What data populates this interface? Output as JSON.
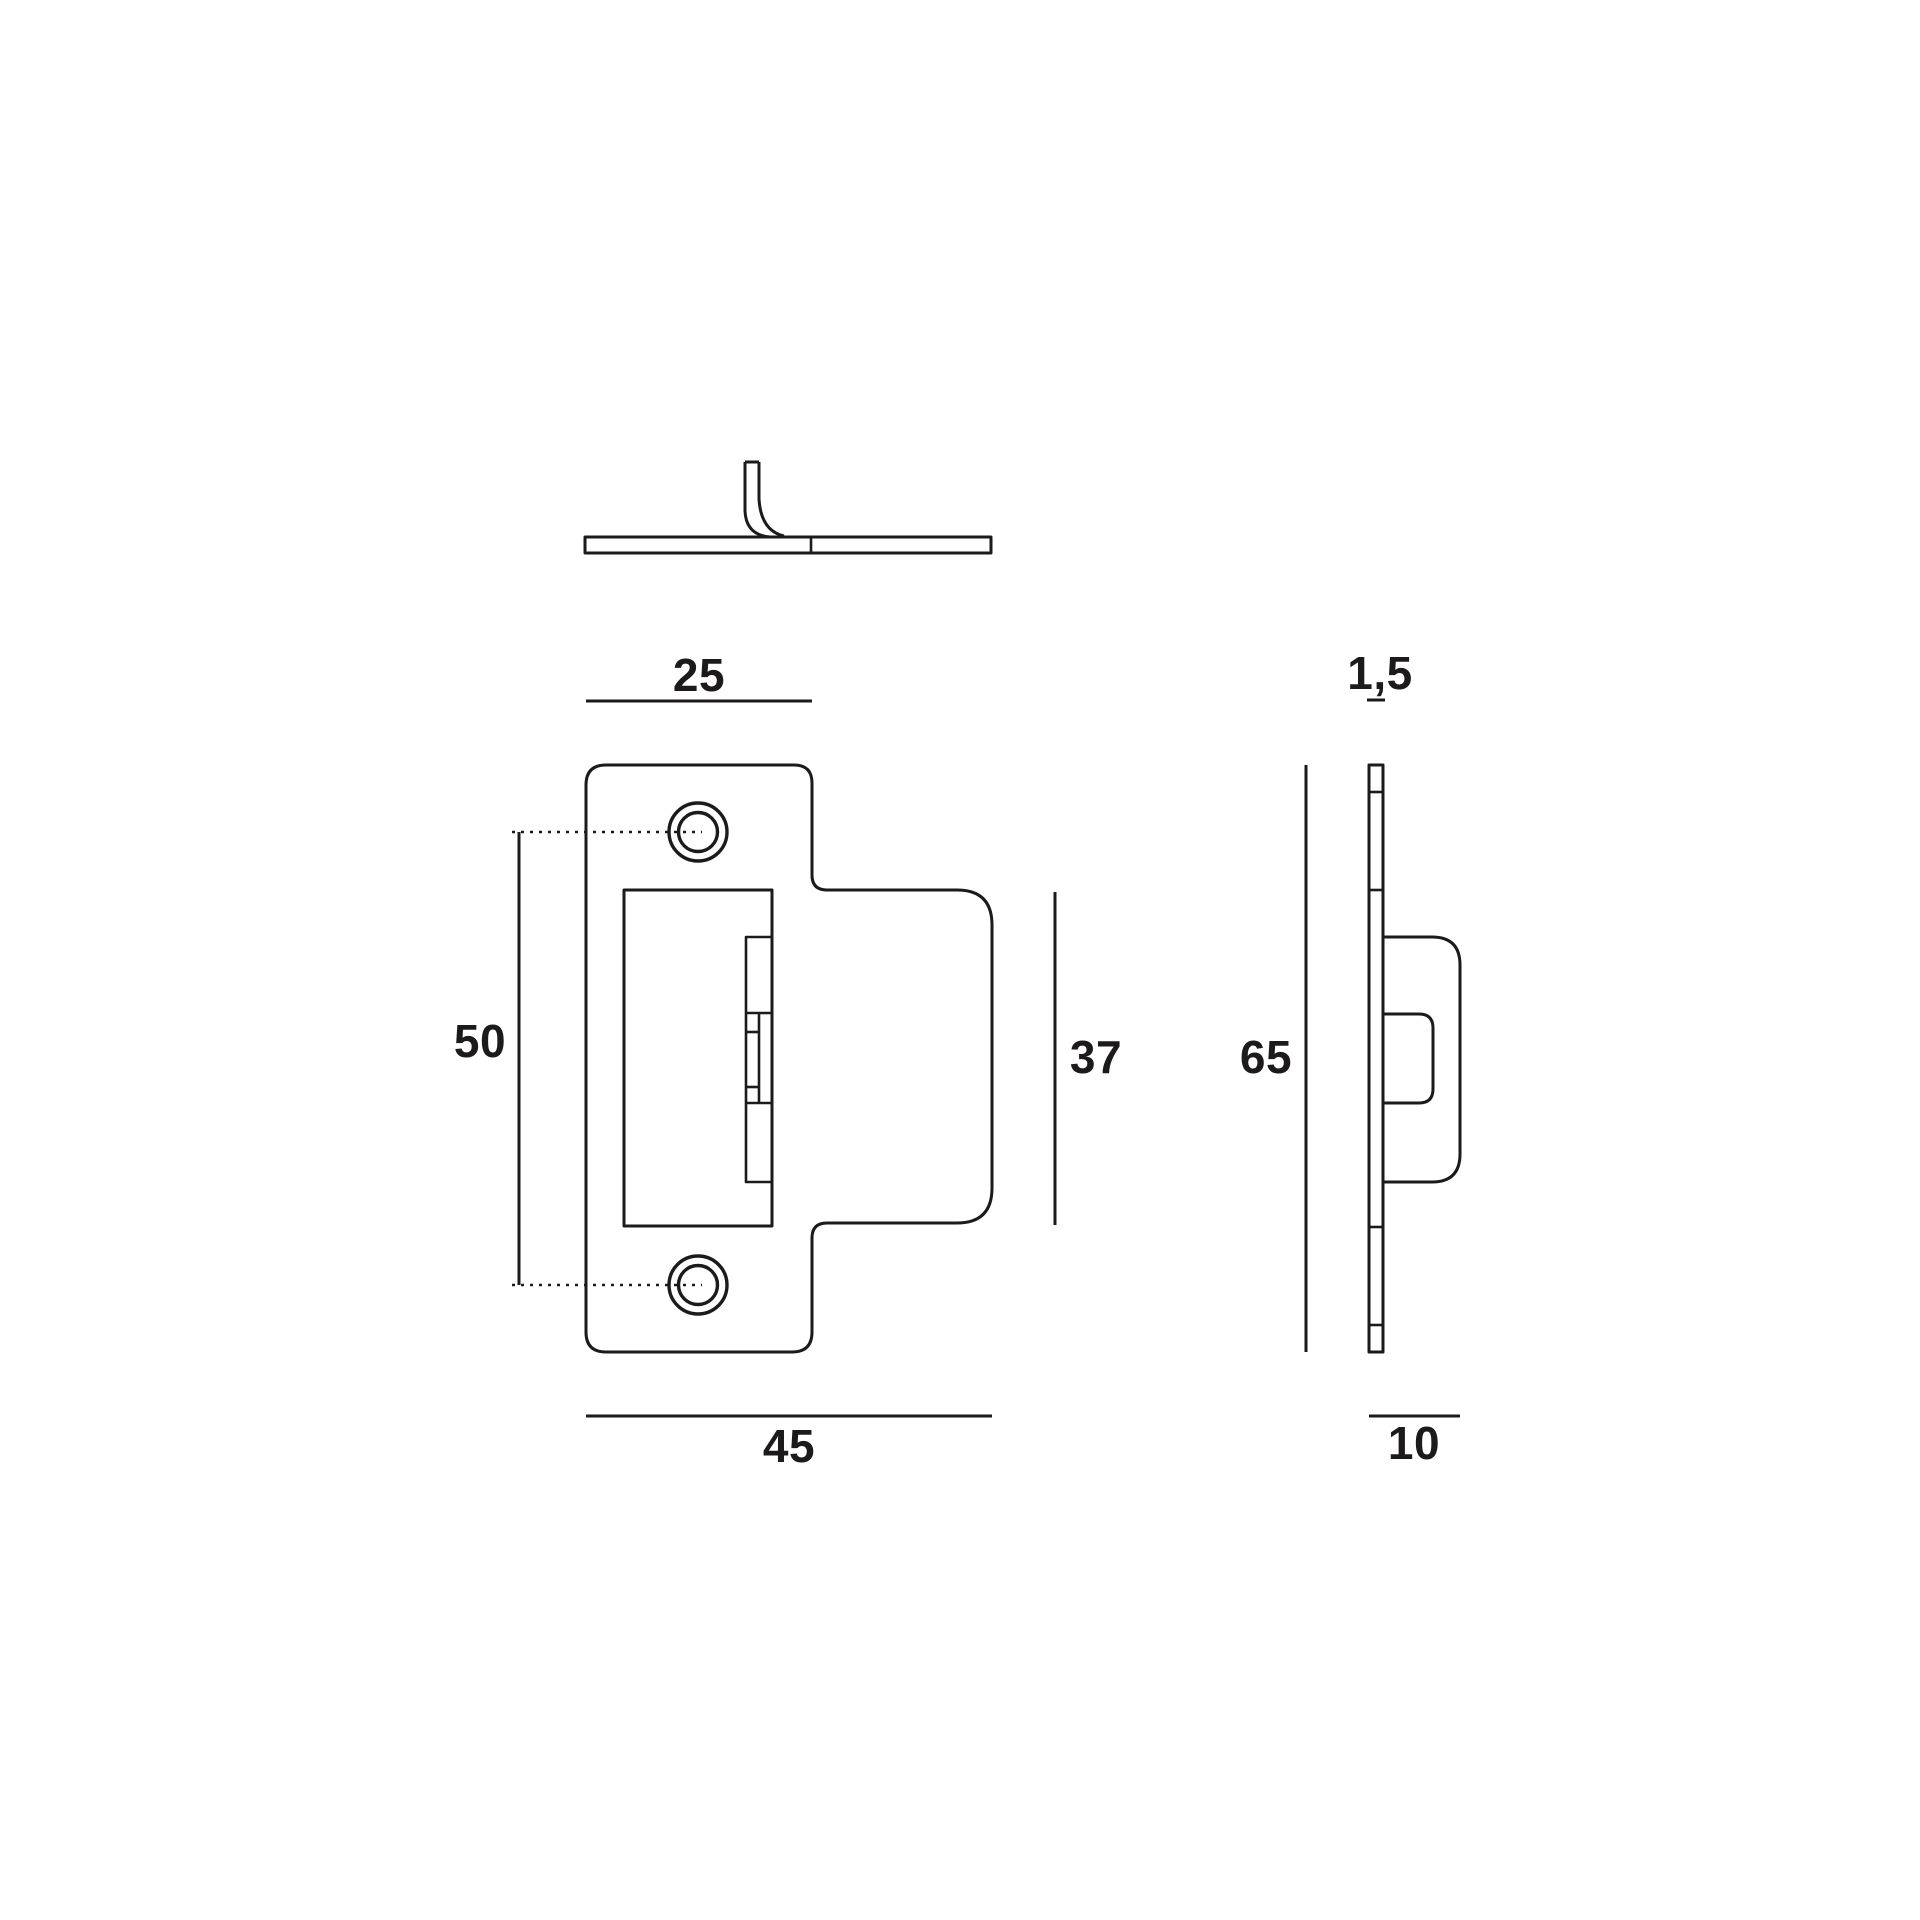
{
  "drawing": {
    "background_color": "#ffffff",
    "line_color": "#1c1a1a",
    "front_view": {
      "top_width_label": "25",
      "overall_width_label": "45",
      "hole_spacing_label": "50",
      "tab_height_label": "37"
    },
    "side_view": {
      "thickness_label": "1,5",
      "overall_height_label": "65",
      "depth_label": "10"
    }
  }
}
